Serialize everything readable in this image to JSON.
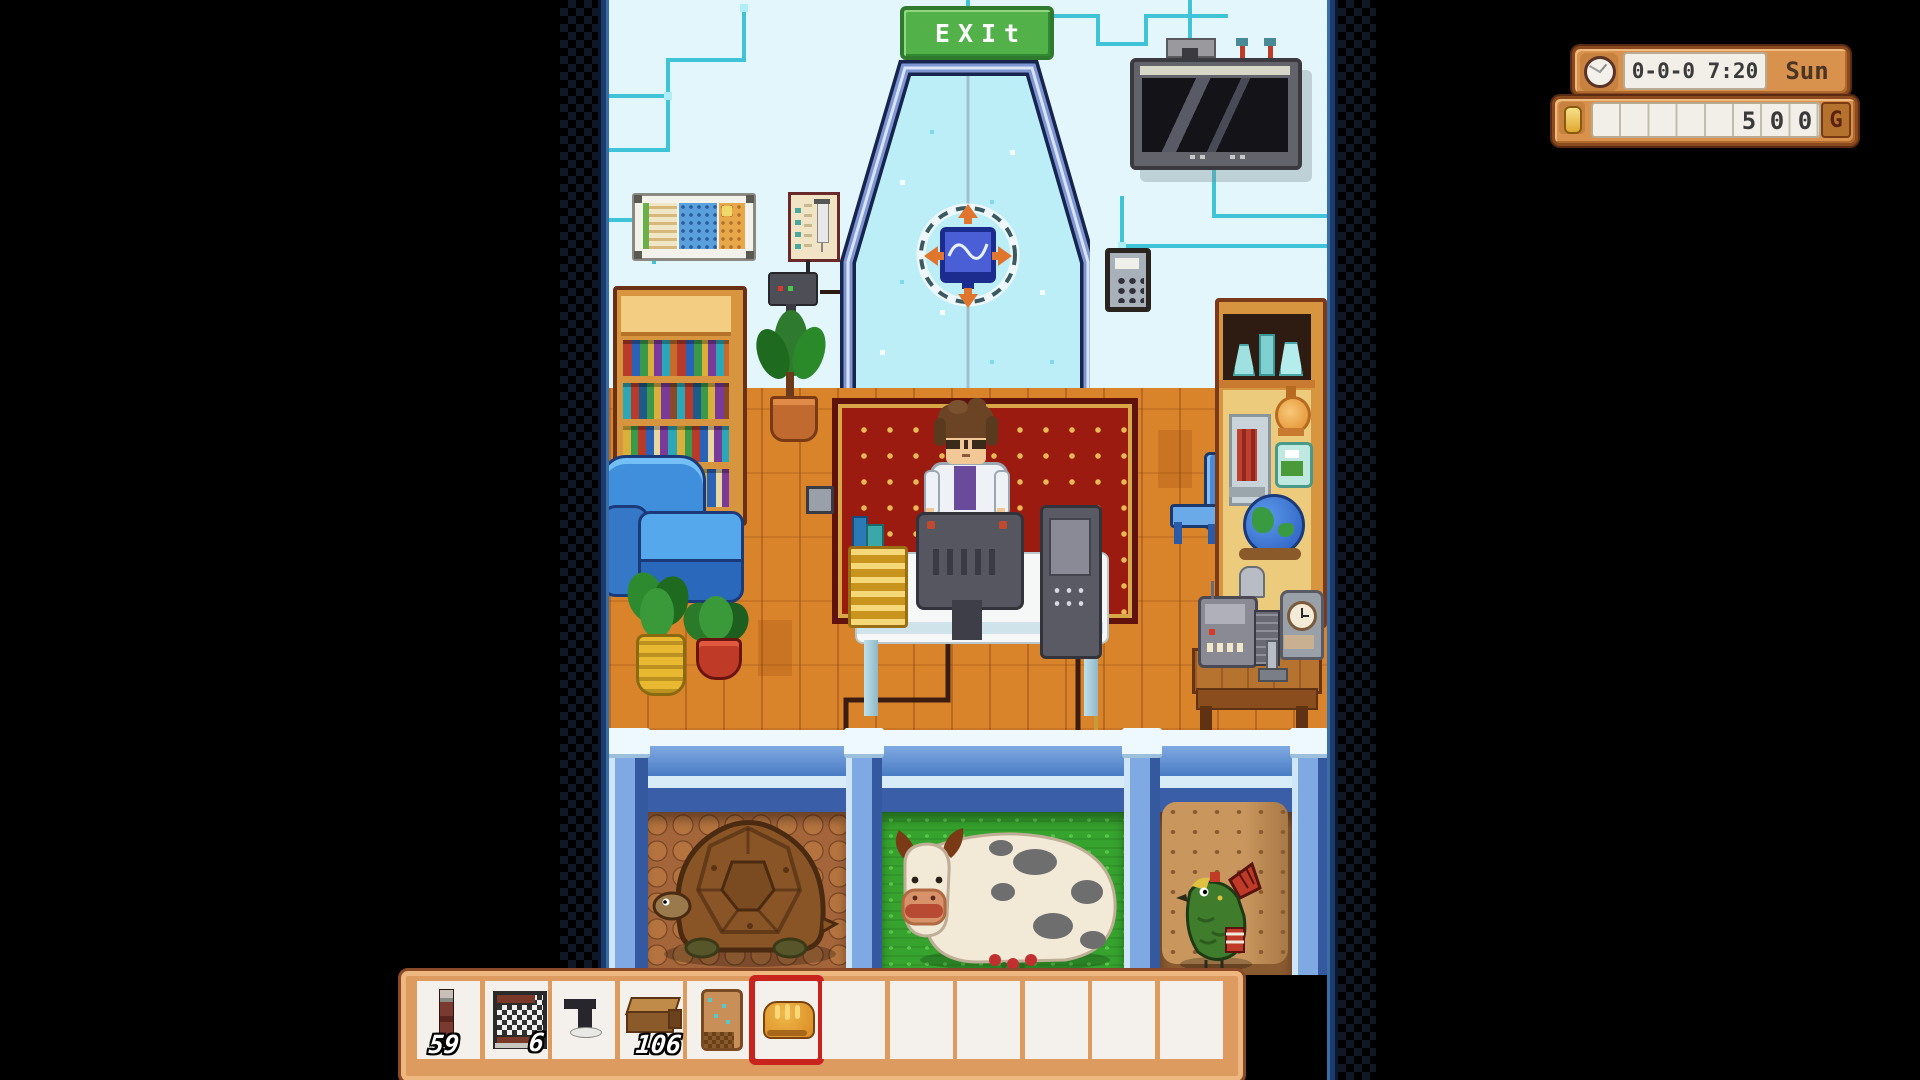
{
  "hud": {
    "time": "0-0-0 7:20",
    "day": "Sun",
    "money_digits": [
      "5",
      "0",
      "0"
    ],
    "currency_label": "G",
    "clock_icon": "clock-icon",
    "coin_icon": "coin-icon"
  },
  "signs": {
    "exit": "EXIt"
  },
  "hotbar": {
    "slot_count": 12,
    "selected_slot": 6,
    "slots": [
      {
        "item": "thermometer-probe",
        "count": "59"
      },
      {
        "item": "crab-pot-cage",
        "count": "6"
      },
      {
        "item": "iron-pipe-tool",
        "count": ""
      },
      {
        "item": "wooden-bench",
        "count": "106"
      },
      {
        "item": "seed-pouch",
        "count": ""
      },
      {
        "item": "bread",
        "count": "",
        "selected": true
      },
      {
        "item": "",
        "count": ""
      },
      {
        "item": "",
        "count": ""
      },
      {
        "item": "",
        "count": ""
      },
      {
        "item": "",
        "count": ""
      },
      {
        "item": "",
        "count": ""
      },
      {
        "item": "",
        "count": ""
      }
    ]
  },
  "scene": {
    "room": "science-lab interior",
    "character": "scientist in lab coat at computer desk",
    "pens": [
      {
        "ground": "cobblestone",
        "animal": "tortoise"
      },
      {
        "ground": "grass",
        "animal": "spotted-cow"
      },
      {
        "ground": "dirt",
        "animal": "green-jungle-chicken"
      }
    ]
  },
  "colors": {
    "hud_frame": "#d8924e",
    "hud_border": "#8a4a1e",
    "selected_slot": "#c8241d",
    "wall": "#e3f6fb",
    "circuit": "#3fc3d6",
    "floor": "#d9832b",
    "rug": "#9c1b10",
    "exit_green": "#53b14a",
    "railing_blue": "#5b8fd4"
  }
}
